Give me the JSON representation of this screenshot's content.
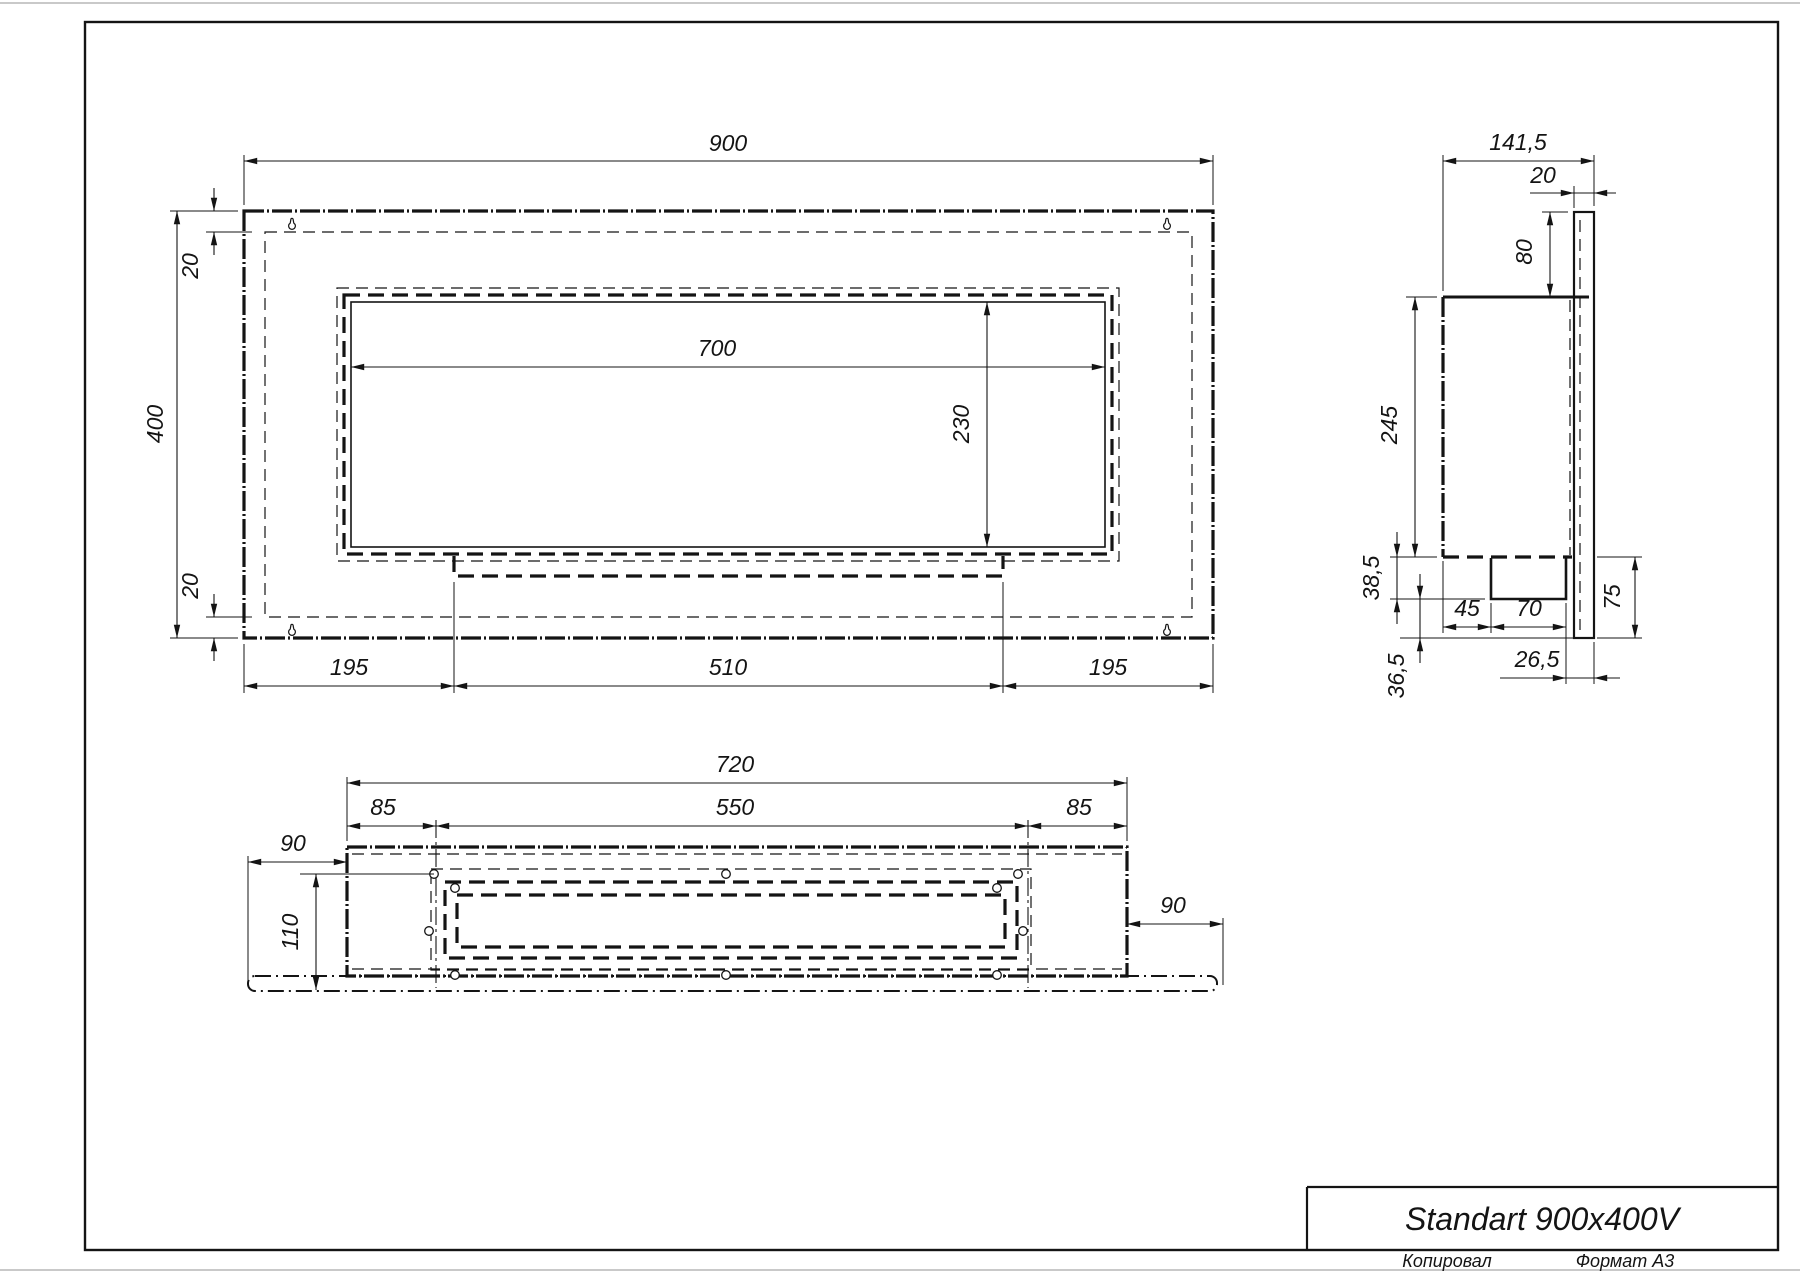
{
  "front_view": {
    "width": "900",
    "height": "400",
    "top_flange": "20",
    "bottom_flange": "20",
    "opening_width": "700",
    "opening_height": "230",
    "bottom_left": "195",
    "bottom_center": "510",
    "bottom_right": "195"
  },
  "side_view": {
    "depth": "141,5",
    "back_gap": "20",
    "above_body": "80",
    "body_height": "245",
    "tray_depth": "38,5",
    "tray_offset": "45",
    "tray_width": "70",
    "tray_to_plate": "26,5",
    "below_tray": "36,5",
    "plate_drop": "75"
  },
  "bottom_view": {
    "width": "720",
    "left_margin": "85",
    "opening_width": "550",
    "right_margin": "85",
    "plate_left": "90",
    "plate_right": "90",
    "depth": "110"
  },
  "title_block": {
    "title": "Standart 900x400V"
  },
  "footer": {
    "copied": "Копировал",
    "format": "Формат А3"
  }
}
